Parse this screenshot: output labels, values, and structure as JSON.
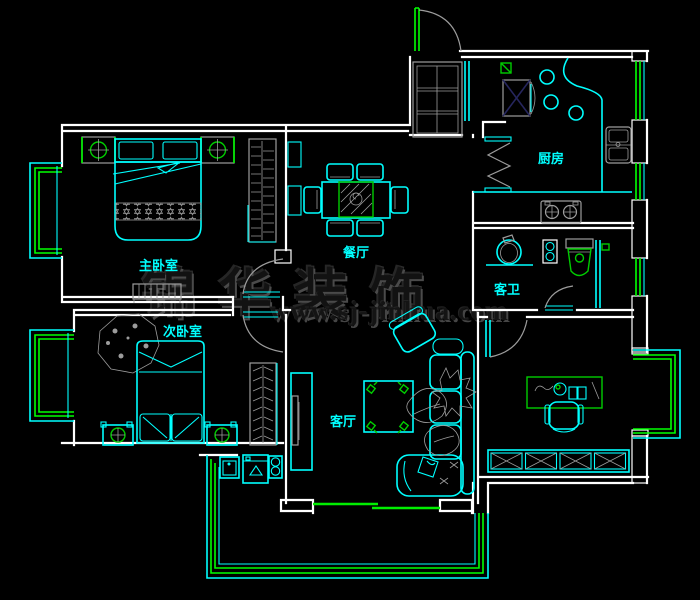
{
  "watermark": {
    "brand": "锦华装饰",
    "website": "www.sj-jinhua.com"
  },
  "rooms": {
    "master_bedroom": {
      "label": "主卧室"
    },
    "second_bedroom": {
      "label": "次卧室"
    },
    "dining_room": {
      "label": "餐厅"
    },
    "kitchen": {
      "label": "厨房"
    },
    "guest_bathroom": {
      "label": "客卫"
    },
    "living_room": {
      "label": "客厅"
    }
  },
  "colors": {
    "background": "#000000",
    "wall": "#ffffff",
    "fixture_cyan": "#00ffff",
    "window_green": "#00ff00",
    "door_green": "#00ee00",
    "furniture_gray": "#9c9c9c",
    "fridge_cross": "#26265e",
    "accent_green": "#00cc00",
    "label_text": "#00ffff",
    "watermark_text": "#3c3c3c"
  }
}
